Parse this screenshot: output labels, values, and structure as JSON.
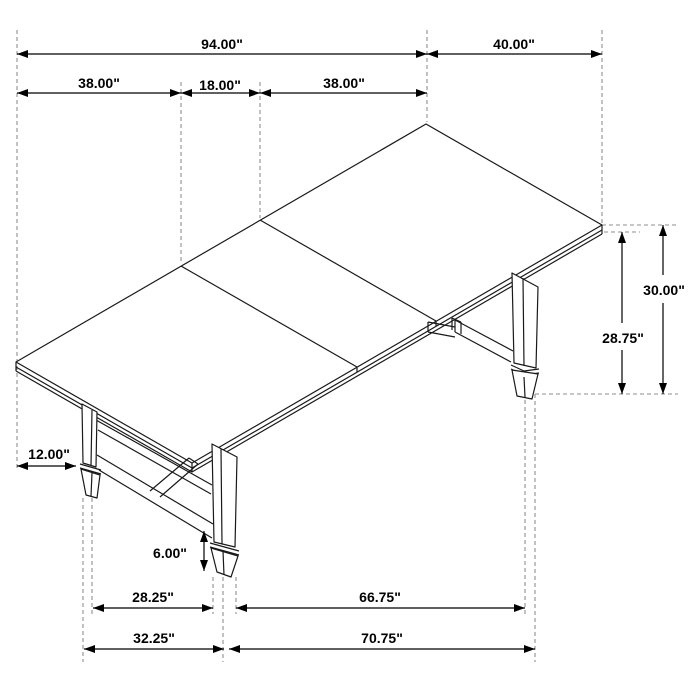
{
  "page": {
    "background": "#ffffff"
  },
  "drawing": {
    "type": "isometric-dimension-diagram",
    "subject": "three-section trestle dining table with two pedestal bases",
    "colors": {
      "furniture_line": "#1a1a1a",
      "dimension_line": "#000000",
      "extension_line": "#8f8f8f",
      "background": "#ffffff"
    },
    "dims": {
      "table_length": "94.00\"",
      "table_width": "40.00\"",
      "leaf_left": "38.00\"",
      "leaf_center": "18.00\"",
      "leaf_right": "38.00\"",
      "height_overall": "30.00\"",
      "height_underside": "28.75\"",
      "end_overhang": "12.00\"",
      "stretcher_depth": "6.00\"",
      "pedestal_span_short_inner": "28.25\"",
      "pedestal_span_long_inner": "66.75\"",
      "pedestal_span_short_outer": "32.25\"",
      "pedestal_span_long_outer": "70.75\""
    }
  }
}
